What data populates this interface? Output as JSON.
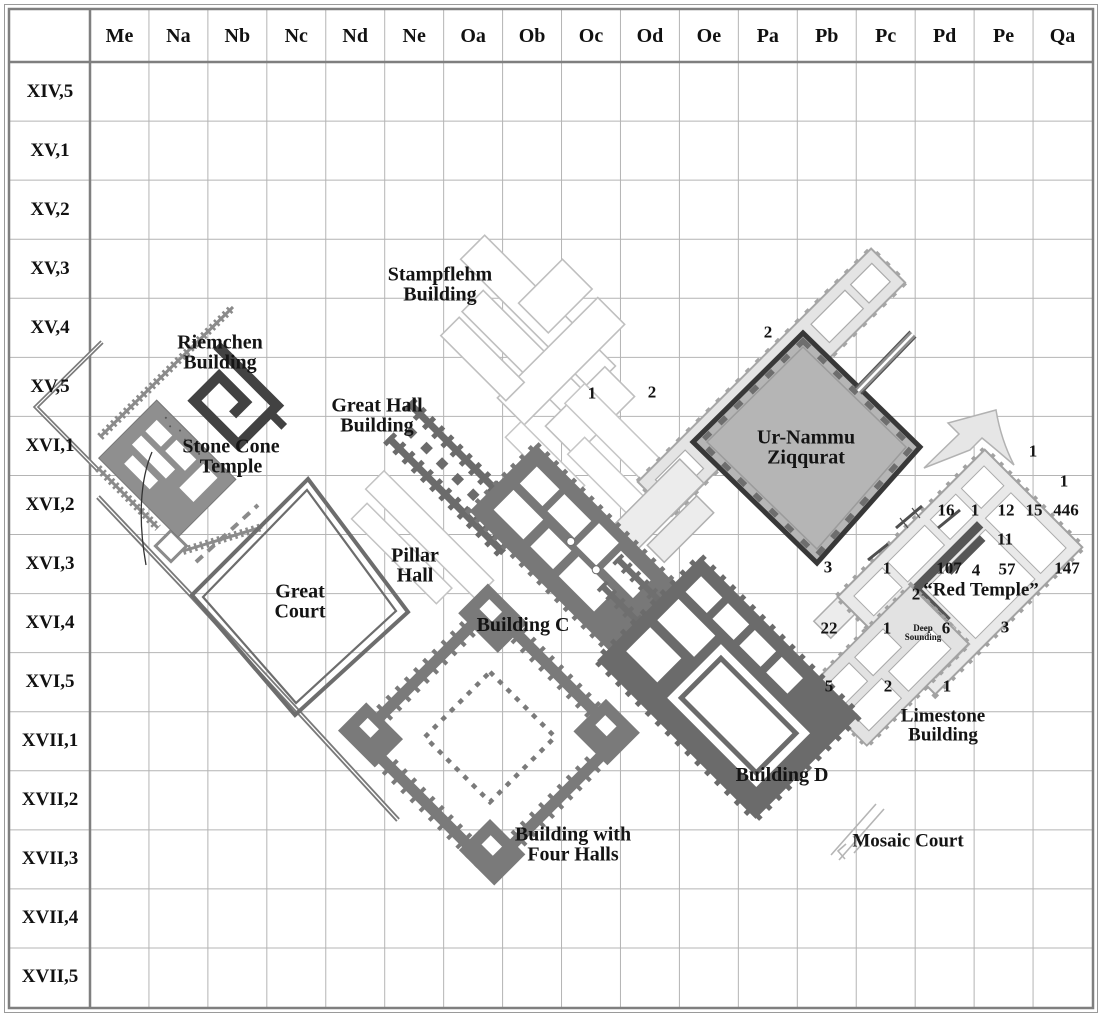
{
  "map": {
    "title": "Excavation grid plan",
    "columns": [
      "Me",
      "Na",
      "Nb",
      "Nc",
      "Nd",
      "Ne",
      "Oa",
      "Ob",
      "Oc",
      "Od",
      "Oe",
      "Pa",
      "Pb",
      "Pc",
      "Pd",
      "Pe",
      "Qa"
    ],
    "rows": [
      "XIV,5",
      "XV,1",
      "XV,2",
      "XV,3",
      "XV,4",
      "XV,5",
      "XVI,1",
      "XVI,2",
      "XVI,3",
      "XVI,4",
      "XVI,5",
      "XVII,1",
      "XVII,2",
      "XVII,3",
      "XVII,4",
      "XVII,5"
    ],
    "building_labels": [
      {
        "name": "riemchen-building",
        "text": "Riemchen\nBuilding",
        "x": 220,
        "y": 353,
        "size": 20
      },
      {
        "name": "stone-cone-temple",
        "text": "Stone Cone\nTemple",
        "x": 231,
        "y": 457,
        "size": 20
      },
      {
        "name": "stampflehm-building",
        "text": "Stampflehm\nBuilding",
        "x": 440,
        "y": 285,
        "size": 20
      },
      {
        "name": "great-hall-building",
        "text": "Great Hall\nBuilding",
        "x": 377,
        "y": 416,
        "size": 20
      },
      {
        "name": "pillar-hall",
        "text": "Pillar\nHall",
        "x": 415,
        "y": 566,
        "size": 20
      },
      {
        "name": "great-court",
        "text": "Great\nCourt",
        "x": 300,
        "y": 602,
        "size": 20
      },
      {
        "name": "building-c",
        "text": "Building C",
        "x": 523,
        "y": 625,
        "size": 20
      },
      {
        "name": "building-with-four-halls",
        "text": "Building with\nFour Halls",
        "x": 573,
        "y": 845,
        "size": 20
      },
      {
        "name": "building-d",
        "text": "Building D",
        "x": 782,
        "y": 775,
        "size": 20
      },
      {
        "name": "ur-nammu-ziqqurat",
        "text": "Ur-Nammu\nZiqqurat",
        "x": 806,
        "y": 448,
        "size": 20
      },
      {
        "name": "red-temple",
        "text": "“Red Temple”",
        "x": 981,
        "y": 590,
        "size": 19
      },
      {
        "name": "deep-sounding",
        "text": "Deep\nSounding",
        "x": 923,
        "y": 633,
        "size": 9
      },
      {
        "name": "limestone-building",
        "text": "Limestone\nBuilding",
        "x": 943,
        "y": 726,
        "size": 19
      },
      {
        "name": "mosaic-court",
        "text": "Mosaic Court",
        "x": 908,
        "y": 841,
        "size": 19
      }
    ],
    "find_counts": [
      {
        "text": "2",
        "x": 768,
        "y": 332
      },
      {
        "text": "1",
        "x": 592,
        "y": 393
      },
      {
        "text": "2",
        "x": 652,
        "y": 392
      },
      {
        "text": "1",
        "x": 1033,
        "y": 451
      },
      {
        "text": "1",
        "x": 1064,
        "y": 481
      },
      {
        "text": "16",
        "x": 946,
        "y": 510
      },
      {
        "text": "1",
        "x": 975,
        "y": 510
      },
      {
        "text": "12",
        "x": 1006,
        "y": 510
      },
      {
        "text": "15",
        "x": 1034,
        "y": 510
      },
      {
        "text": "446",
        "x": 1066,
        "y": 510
      },
      {
        "text": "11",
        "x": 1005,
        "y": 539
      },
      {
        "text": "3",
        "x": 828,
        "y": 567
      },
      {
        "text": "1",
        "x": 887,
        "y": 568
      },
      {
        "text": "107",
        "x": 949,
        "y": 568
      },
      {
        "text": "4",
        "x": 976,
        "y": 570
      },
      {
        "text": "57",
        "x": 1007,
        "y": 569
      },
      {
        "text": "147",
        "x": 1067,
        "y": 568
      },
      {
        "text": "2",
        "x": 916,
        "y": 594
      },
      {
        "text": "22",
        "x": 829,
        "y": 628
      },
      {
        "text": "1",
        "x": 887,
        "y": 628
      },
      {
        "text": "6",
        "x": 946,
        "y": 628
      },
      {
        "text": "3",
        "x": 1005,
        "y": 627
      },
      {
        "text": "5",
        "x": 829,
        "y": 686
      },
      {
        "text": "2",
        "x": 888,
        "y": 686
      },
      {
        "text": "1",
        "x": 947,
        "y": 686
      }
    ],
    "colors": {
      "grid_line": "#b4b4b4",
      "frame": "#7f7f7f",
      "dark_building": "#424242",
      "mid_building": "#6f6f6f",
      "light_building": "#e6e6e6",
      "ziggurat_fill": "#b5b5b5",
      "ziggurat_edge": "#383838"
    }
  }
}
